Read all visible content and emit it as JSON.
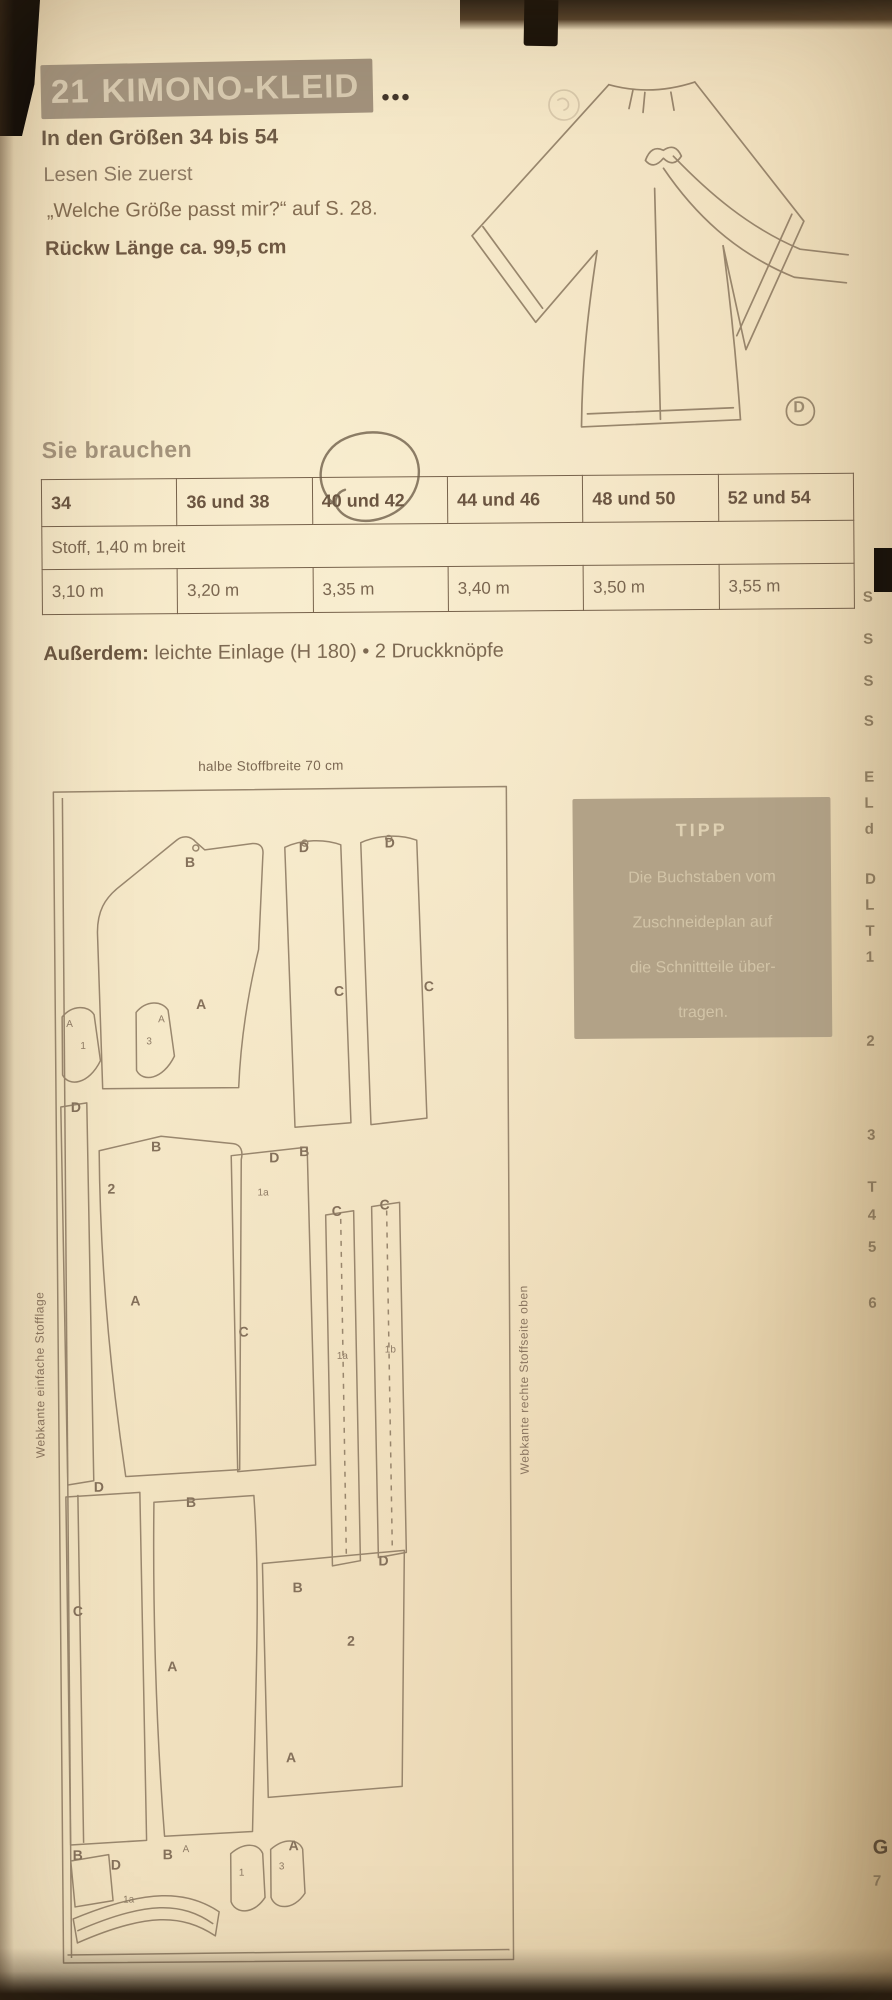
{
  "page": {
    "title_number": "21",
    "title_text": "KIMONO-KLEID",
    "difficulty_dots": "●●●",
    "sizes_line": "In den Größen 34 bis 54",
    "read_first_line1": "Lesen Sie zuerst",
    "read_first_line2": "„Welche Größe passt mir?“ auf S. 28.",
    "back_length_line": "Rückw Länge ca. 99,5 cm",
    "view_label": "D"
  },
  "you_need": {
    "heading": "Sie brauchen",
    "table": {
      "size_headers": [
        "34",
        "36 und 38",
        "40 und 42",
        "44 und 46",
        "48 und 50",
        "52 und 54"
      ],
      "fabric_row_label": "Stoff, 1,40 m breit",
      "fabric_amounts": [
        "3,10 m",
        "3,20 m",
        "3,35 m",
        "3,40 m",
        "3,50 m",
        "3,55 m"
      ],
      "circled_column": "40 und 42"
    },
    "additional_label": "Außerdem:",
    "additional_text": " leichte Einlage (H 180) • 2 Druckknöpfe"
  },
  "cutting_layout": {
    "top_label": "halbe Stoffbreite 70 cm",
    "left_edge_label": "Webkante einfache Stofflage",
    "right_edge_label": "Webkante rechte Stoffseite oben",
    "piece_letters": [
      {
        "t": "B",
        "x": 186,
        "y": 852
      },
      {
        "t": "D",
        "x": 300,
        "y": 838
      },
      {
        "t": "D",
        "x": 386,
        "y": 834
      },
      {
        "t": "A",
        "x": 196,
        "y": 994
      },
      {
        "t": "C",
        "x": 334,
        "y": 982
      },
      {
        "t": "C",
        "x": 424,
        "y": 978
      },
      {
        "t": "A",
        "x": 66,
        "y": 1016,
        "small": true
      },
      {
        "t": "1",
        "x": 80,
        "y": 1038,
        "small": true
      },
      {
        "t": "A",
        "x": 158,
        "y": 1012,
        "small": true
      },
      {
        "t": "3",
        "x": 146,
        "y": 1034,
        "small": true
      },
      {
        "t": "D",
        "x": 70,
        "y": 1096
      },
      {
        "t": "B",
        "x": 150,
        "y": 1136
      },
      {
        "t": "2",
        "x": 106,
        "y": 1178
      },
      {
        "t": "D",
        "x": 268,
        "y": 1148
      },
      {
        "t": "B",
        "x": 298,
        "y": 1142
      },
      {
        "t": "1a",
        "x": 256,
        "y": 1186,
        "small": true
      },
      {
        "t": "C",
        "x": 330,
        "y": 1202
      },
      {
        "t": "C",
        "x": 378,
        "y": 1196
      },
      {
        "t": "A",
        "x": 128,
        "y": 1290
      },
      {
        "t": "C",
        "x": 236,
        "y": 1322
      },
      {
        "t": "1a",
        "x": 334,
        "y": 1350,
        "small": true
      },
      {
        "t": "1b",
        "x": 382,
        "y": 1344,
        "small": true
      },
      {
        "t": "D",
        "x": 90,
        "y": 1476
      },
      {
        "t": "C",
        "x": 68,
        "y": 1600
      },
      {
        "t": "B",
        "x": 182,
        "y": 1492
      },
      {
        "t": "A",
        "x": 162,
        "y": 1656
      },
      {
        "t": "D",
        "x": 374,
        "y": 1552
      },
      {
        "t": "B",
        "x": 288,
        "y": 1578
      },
      {
        "t": "2",
        "x": 342,
        "y": 1632
      },
      {
        "t": "A",
        "x": 280,
        "y": 1748
      },
      {
        "t": "B",
        "x": 66,
        "y": 1844
      },
      {
        "t": "D",
        "x": 104,
        "y": 1854
      },
      {
        "t": "1a",
        "x": 116,
        "y": 1892,
        "small": true
      },
      {
        "t": "B",
        "x": 156,
        "y": 1844
      },
      {
        "t": "A",
        "x": 176,
        "y": 1842,
        "small": true
      },
      {
        "t": "1",
        "x": 232,
        "y": 1866,
        "small": true
      },
      {
        "t": "3",
        "x": 272,
        "y": 1860,
        "small": true
      },
      {
        "t": "A",
        "x": 282,
        "y": 1836
      }
    ]
  },
  "tip_box": {
    "heading": "TIPP",
    "lines": [
      "Die Buchstaben vom",
      "Zuschneideplan auf",
      "die Schnittteile über-",
      "tragen."
    ]
  },
  "right_edge_fragments": [
    {
      "ch": "S",
      "top": 592
    },
    {
      "ch": "S",
      "top": 634
    },
    {
      "ch": "S",
      "top": 676
    },
    {
      "ch": "S",
      "top": 716
    },
    {
      "ch": "E",
      "top": 772
    },
    {
      "ch": "L",
      "top": 798
    },
    {
      "ch": "d",
      "top": 824
    },
    {
      "ch": "D",
      "top": 874
    },
    {
      "ch": "L",
      "top": 900
    },
    {
      "ch": "T",
      "top": 926
    },
    {
      "ch": "1",
      "top": 952
    },
    {
      "ch": "2",
      "top": 1036
    },
    {
      "ch": "3",
      "top": 1130
    },
    {
      "ch": "T",
      "top": 1182
    },
    {
      "ch": "4",
      "top": 1210
    },
    {
      "ch": "5",
      "top": 1242
    },
    {
      "ch": "6",
      "top": 1298
    },
    {
      "ch": "G",
      "top": 1840,
      "bold": true
    },
    {
      "ch": "7",
      "top": 1876
    }
  ],
  "colors": {
    "page_paper": "#eedcba",
    "ink_brown": "#6b5845",
    "title_box_bg": "#a2927c",
    "tip_box_bg": "#b2a287",
    "pencil_annotation": "#6d5c48",
    "drawing_line": "#8f7c63"
  }
}
